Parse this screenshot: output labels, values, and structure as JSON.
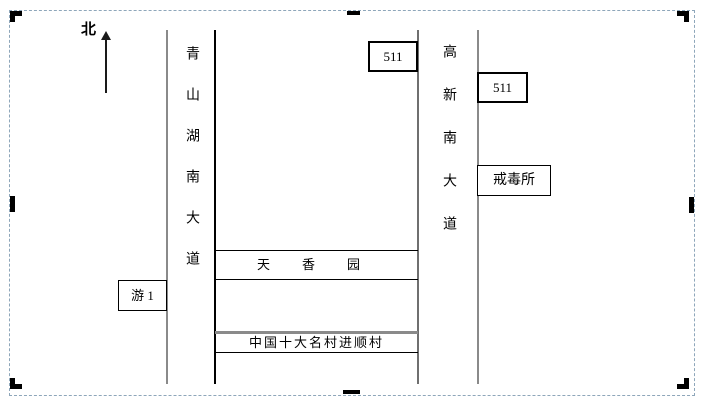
{
  "compass": {
    "north_label": "北"
  },
  "roads": {
    "left_vertical": {
      "label": "青山湖南大道"
    },
    "right_vertical": {
      "label": "高新南大道"
    }
  },
  "places": {
    "tianxiangyuan": {
      "label": "天香园"
    },
    "jinshuncun": {
      "label": "中国十大名村进顺村"
    }
  },
  "stops": {
    "bus_511_qingshan": {
      "label": "511"
    },
    "bus_511_gaoxin": {
      "label": "511"
    },
    "jiedusuo": {
      "label": "戒毒所"
    },
    "you_1": {
      "label": "游 1"
    }
  },
  "colors": {
    "frame_dash": "#8ea6ba",
    "road_line_gray": "#8a8a8a",
    "line_black": "#000000",
    "background": "#ffffff"
  }
}
